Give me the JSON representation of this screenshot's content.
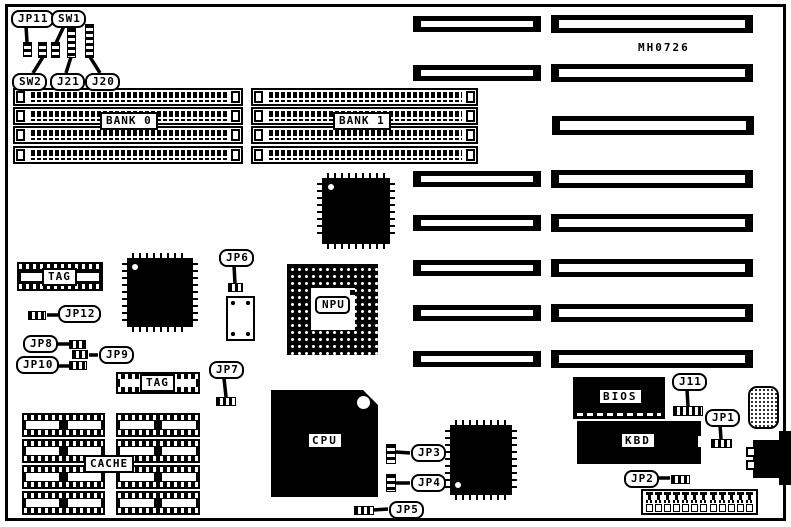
{
  "board": {
    "part_number": "MH0726"
  },
  "labels": {
    "jp11": "JP11",
    "sw1": "SW1",
    "sw2": "SW2",
    "j21": "J21",
    "j20": "J20",
    "bank0": "BANK 0",
    "bank1": "BANK 1",
    "tag1": "TAG",
    "tag2": "TAG",
    "cache": "CACHE",
    "jp12": "JP12",
    "jp8": "JP8",
    "jp9": "JP9",
    "jp10": "JP10",
    "jp6": "JP6",
    "jp7": "JP7",
    "npu": "NPU",
    "cpu": "CPU",
    "bios": "BIOS",
    "kbd": "KBD",
    "j11": "J11",
    "jp1": "JP1",
    "jp2": "JP2",
    "jp3": "JP3",
    "jp4": "JP4",
    "jp5": "JP5"
  },
  "power_connector": {
    "pin_count": 12
  },
  "colors": {
    "ink": "#000000",
    "paper": "#ffffff"
  }
}
